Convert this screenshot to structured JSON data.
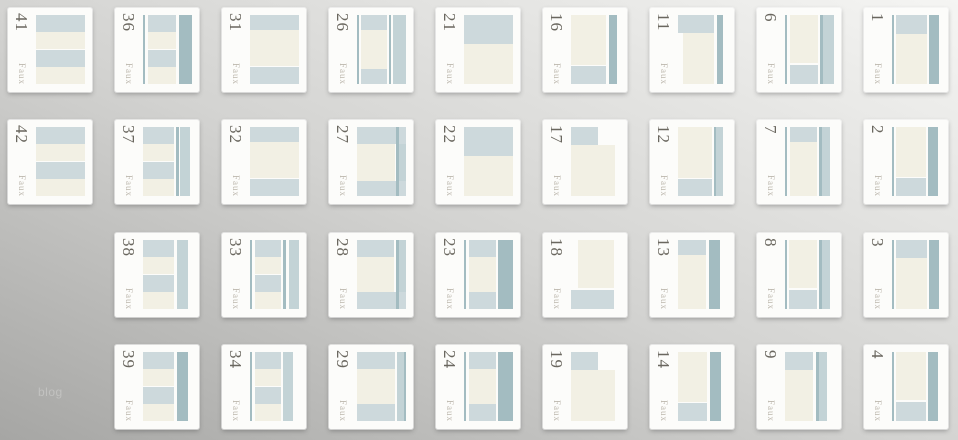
{
  "page": {
    "side_text": "blog",
    "watermark_label": "Faux"
  },
  "palette": {
    "light": "#cdd9dc",
    "mid": "#c3d3d6",
    "dark": "#a3bcc1",
    "cream": "#f2f0e4",
    "card_bg": "#fcfcfa",
    "number_color": "#6a675f",
    "label_color": "#bcb7ad",
    "blog_color": "#c2c2c0",
    "bg_top_right": "#f5f5f3",
    "bg_mid": "#d3d3d1",
    "bg_bottom_left": "#a6a6a4"
  },
  "grid": {
    "columns": 9,
    "rows": 4,
    "origin_x": 8,
    "col_pitch": 107,
    "row_tops": [
      8,
      120,
      233,
      345
    ],
    "card_size": 84
  },
  "cards": [
    {
      "number": "41",
      "col": 1,
      "row": 1,
      "blocks": [
        [
          0,
          0,
          100,
          24,
          "L"
        ],
        [
          0,
          24,
          100,
          26,
          "C"
        ],
        [
          0,
          50,
          100,
          26,
          "L"
        ],
        [
          0,
          76,
          100,
          24,
          "C"
        ]
      ]
    },
    {
      "number": "42",
      "col": 1,
      "row": 2,
      "blocks": [
        [
          0,
          0,
          100,
          24,
          "L"
        ],
        [
          0,
          24,
          100,
          26,
          "C"
        ],
        [
          0,
          50,
          100,
          26,
          "L"
        ],
        [
          0,
          76,
          100,
          24,
          "C"
        ]
      ]
    },
    {
      "number": "36",
      "col": 2,
      "row": 1,
      "blocks": [
        [
          0,
          0,
          5,
          100,
          "D"
        ],
        [
          10,
          0,
          58,
          24,
          "L"
        ],
        [
          10,
          24,
          58,
          26,
          "C"
        ],
        [
          10,
          50,
          58,
          26,
          "L"
        ],
        [
          10,
          76,
          58,
          24,
          "C"
        ],
        [
          73,
          0,
          27,
          100,
          "D"
        ]
      ]
    },
    {
      "number": "37",
      "col": 2,
      "row": 2,
      "blocks": [
        [
          0,
          0,
          64,
          24,
          "L"
        ],
        [
          0,
          24,
          64,
          26,
          "C"
        ],
        [
          0,
          50,
          64,
          26,
          "L"
        ],
        [
          0,
          76,
          64,
          24,
          "C"
        ],
        [
          68,
          0,
          5,
          100,
          "D"
        ],
        [
          75,
          0,
          21,
          100,
          "M"
        ]
      ]
    },
    {
      "number": "38",
      "col": 2,
      "row": 3,
      "blocks": [
        [
          0,
          0,
          64,
          24,
          "L"
        ],
        [
          0,
          24,
          64,
          26,
          "C"
        ],
        [
          0,
          50,
          64,
          26,
          "L"
        ],
        [
          0,
          76,
          64,
          24,
          "C"
        ],
        [
          70,
          0,
          22,
          100,
          "M"
        ]
      ]
    },
    {
      "number": "39",
      "col": 2,
      "row": 4,
      "blocks": [
        [
          0,
          0,
          64,
          24,
          "L"
        ],
        [
          0,
          24,
          64,
          26,
          "C"
        ],
        [
          0,
          50,
          64,
          26,
          "L"
        ],
        [
          0,
          76,
          64,
          24,
          "C"
        ],
        [
          70,
          0,
          22,
          100,
          "D"
        ]
      ]
    },
    {
      "number": "31",
      "col": 3,
      "row": 1,
      "blocks": [
        [
          0,
          0,
          100,
          22,
          "L"
        ],
        [
          0,
          22,
          100,
          52,
          "C"
        ],
        [
          0,
          76,
          100,
          24,
          "L"
        ]
      ]
    },
    {
      "number": "32",
      "col": 3,
      "row": 2,
      "blocks": [
        [
          0,
          0,
          100,
          22,
          "L"
        ],
        [
          0,
          22,
          100,
          52,
          "C"
        ],
        [
          0,
          76,
          100,
          24,
          "L"
        ]
      ]
    },
    {
      "number": "33",
      "col": 3,
      "row": 3,
      "blocks": [
        [
          0,
          0,
          5,
          100,
          "D"
        ],
        [
          10,
          0,
          54,
          24,
          "L"
        ],
        [
          10,
          24,
          54,
          26,
          "C"
        ],
        [
          10,
          50,
          54,
          26,
          "L"
        ],
        [
          10,
          76,
          54,
          24,
          "C"
        ],
        [
          68,
          0,
          5,
          100,
          "D"
        ],
        [
          79,
          0,
          21,
          100,
          "M"
        ]
      ]
    },
    {
      "number": "34",
      "col": 3,
      "row": 4,
      "blocks": [
        [
          0,
          0,
          5,
          100,
          "D"
        ],
        [
          10,
          0,
          54,
          24,
          "L"
        ],
        [
          10,
          24,
          54,
          26,
          "C"
        ],
        [
          10,
          50,
          54,
          26,
          "L"
        ],
        [
          10,
          76,
          54,
          24,
          "C"
        ],
        [
          68,
          0,
          20,
          100,
          "M"
        ]
      ]
    },
    {
      "number": "26",
      "col": 4,
      "row": 1,
      "blocks": [
        [
          0,
          0,
          4,
          100,
          "D"
        ],
        [
          8,
          0,
          54,
          22,
          "L"
        ],
        [
          8,
          22,
          54,
          56,
          "C"
        ],
        [
          8,
          78,
          54,
          22,
          "L"
        ],
        [
          66,
          0,
          4,
          100,
          "D"
        ],
        [
          74,
          0,
          26,
          100,
          "M"
        ]
      ]
    },
    {
      "number": "27",
      "col": 4,
      "row": 2,
      "blocks": [
        [
          0,
          0,
          100,
          24,
          "L"
        ],
        [
          0,
          24,
          78,
          54,
          "C"
        ],
        [
          0,
          78,
          100,
          22,
          "L"
        ],
        [
          80,
          0,
          5,
          100,
          "D"
        ],
        [
          85,
          24,
          15,
          54,
          "M"
        ]
      ]
    },
    {
      "number": "28",
      "col": 4,
      "row": 3,
      "blocks": [
        [
          0,
          0,
          76,
          24,
          "L"
        ],
        [
          0,
          24,
          76,
          52,
          "C"
        ],
        [
          0,
          76,
          100,
          24,
          "L"
        ],
        [
          80,
          0,
          5,
          100,
          "D"
        ],
        [
          85,
          0,
          15,
          76,
          "M"
        ]
      ]
    },
    {
      "number": "29",
      "col": 4,
      "row": 4,
      "blocks": [
        [
          0,
          0,
          78,
          24,
          "L"
        ],
        [
          0,
          24,
          78,
          52,
          "C"
        ],
        [
          0,
          76,
          78,
          24,
          "L"
        ],
        [
          82,
          0,
          14,
          100,
          "M"
        ],
        [
          96,
          0,
          4,
          100,
          "D"
        ]
      ]
    },
    {
      "number": "21",
      "col": 5,
      "row": 1,
      "blocks": [
        [
          0,
          0,
          100,
          42,
          "L"
        ],
        [
          0,
          42,
          100,
          58,
          "C"
        ]
      ]
    },
    {
      "number": "22",
      "col": 5,
      "row": 2,
      "blocks": [
        [
          0,
          0,
          100,
          42,
          "L"
        ],
        [
          0,
          42,
          100,
          58,
          "C"
        ]
      ]
    },
    {
      "number": "23",
      "col": 5,
      "row": 3,
      "blocks": [
        [
          0,
          0,
          5,
          100,
          "D"
        ],
        [
          10,
          0,
          56,
          24,
          "L"
        ],
        [
          10,
          24,
          56,
          52,
          "C"
        ],
        [
          10,
          76,
          56,
          24,
          "L"
        ],
        [
          70,
          0,
          30,
          100,
          "D"
        ]
      ]
    },
    {
      "number": "24",
      "col": 5,
      "row": 4,
      "blocks": [
        [
          0,
          0,
          5,
          100,
          "D"
        ],
        [
          10,
          0,
          56,
          24,
          "L"
        ],
        [
          10,
          24,
          56,
          52,
          "C"
        ],
        [
          10,
          76,
          56,
          24,
          "L"
        ],
        [
          70,
          0,
          30,
          100,
          "D"
        ]
      ]
    },
    {
      "number": "16",
      "col": 6,
      "row": 1,
      "blocks": [
        [
          0,
          0,
          72,
          72,
          "C"
        ],
        [
          0,
          74,
          72,
          26,
          "L"
        ],
        [
          78,
          0,
          15,
          100,
          "D"
        ]
      ]
    },
    {
      "number": "17",
      "col": 6,
      "row": 2,
      "blocks": [
        [
          0,
          0,
          56,
          26,
          "L"
        ],
        [
          0,
          26,
          90,
          74,
          "C"
        ]
      ]
    },
    {
      "number": "18",
      "col": 6,
      "row": 3,
      "blocks": [
        [
          14,
          0,
          74,
          70,
          "C"
        ],
        [
          0,
          72,
          88,
          28,
          "L"
        ]
      ]
    },
    {
      "number": "19",
      "col": 6,
      "row": 4,
      "blocks": [
        [
          0,
          0,
          56,
          26,
          "L"
        ],
        [
          0,
          26,
          90,
          74,
          "C"
        ]
      ]
    },
    {
      "number": "11",
      "col": 7,
      "row": 1,
      "blocks": [
        [
          0,
          0,
          74,
          26,
          "L"
        ],
        [
          10,
          26,
          64,
          74,
          "C"
        ],
        [
          79,
          0,
          13,
          100,
          "D"
        ]
      ]
    },
    {
      "number": "12",
      "col": 7,
      "row": 2,
      "blocks": [
        [
          0,
          0,
          70,
          74,
          "C"
        ],
        [
          0,
          76,
          70,
          24,
          "L"
        ],
        [
          73,
          0,
          5,
          100,
          "D"
        ],
        [
          78,
          0,
          14,
          100,
          "M"
        ]
      ]
    },
    {
      "number": "13",
      "col": 7,
      "row": 3,
      "blocks": [
        [
          0,
          0,
          58,
          22,
          "L"
        ],
        [
          0,
          22,
          58,
          78,
          "C"
        ],
        [
          63,
          0,
          22,
          100,
          "D"
        ]
      ]
    },
    {
      "number": "14",
      "col": 7,
      "row": 4,
      "blocks": [
        [
          0,
          0,
          60,
          72,
          "C"
        ],
        [
          0,
          74,
          60,
          26,
          "L"
        ],
        [
          65,
          0,
          22,
          100,
          "D"
        ]
      ]
    },
    {
      "number": "6",
      "col": 8,
      "row": 1,
      "blocks": [
        [
          0,
          0,
          5,
          100,
          "D"
        ],
        [
          10,
          0,
          58,
          70,
          "C"
        ],
        [
          10,
          72,
          58,
          28,
          "L"
        ],
        [
          72,
          0,
          5,
          100,
          "D"
        ],
        [
          77,
          0,
          23,
          100,
          "M"
        ]
      ]
    },
    {
      "number": "7",
      "col": 8,
      "row": 2,
      "blocks": [
        [
          0,
          0,
          5,
          100,
          "D"
        ],
        [
          10,
          0,
          56,
          22,
          "L"
        ],
        [
          10,
          22,
          56,
          78,
          "C"
        ],
        [
          70,
          0,
          5,
          100,
          "D"
        ],
        [
          75,
          0,
          17,
          100,
          "M"
        ]
      ]
    },
    {
      "number": "8",
      "col": 8,
      "row": 3,
      "blocks": [
        [
          0,
          0,
          5,
          100,
          "D"
        ],
        [
          9,
          0,
          57,
          70,
          "C"
        ],
        [
          9,
          72,
          57,
          28,
          "L"
        ],
        [
          70,
          0,
          5,
          100,
          "D"
        ],
        [
          75,
          0,
          17,
          100,
          "M"
        ]
      ]
    },
    {
      "number": "9",
      "col": 8,
      "row": 4,
      "blocks": [
        [
          0,
          0,
          58,
          26,
          "L"
        ],
        [
          0,
          26,
          58,
          74,
          "C"
        ],
        [
          64,
          0,
          5,
          100,
          "D"
        ],
        [
          69,
          0,
          17,
          100,
          "M"
        ]
      ]
    },
    {
      "number": "1",
      "col": 9,
      "row": 1,
      "blocks": [
        [
          0,
          0,
          5,
          100,
          "D"
        ],
        [
          9,
          0,
          62,
          28,
          "L"
        ],
        [
          9,
          28,
          62,
          72,
          "C"
        ],
        [
          75,
          0,
          21,
          100,
          "D"
        ]
      ]
    },
    {
      "number": "2",
      "col": 9,
      "row": 2,
      "blocks": [
        [
          0,
          0,
          5,
          100,
          "D"
        ],
        [
          9,
          0,
          60,
          72,
          "C"
        ],
        [
          9,
          74,
          60,
          26,
          "L"
        ],
        [
          73,
          0,
          21,
          100,
          "D"
        ]
      ]
    },
    {
      "number": "3",
      "col": 9,
      "row": 3,
      "blocks": [
        [
          0,
          0,
          5,
          100,
          "D"
        ],
        [
          9,
          0,
          62,
          26,
          "L"
        ],
        [
          9,
          26,
          62,
          74,
          "C"
        ],
        [
          75,
          0,
          21,
          100,
          "D"
        ]
      ]
    },
    {
      "number": "4",
      "col": 9,
      "row": 4,
      "blocks": [
        [
          0,
          0,
          5,
          100,
          "D"
        ],
        [
          9,
          0,
          60,
          70,
          "C"
        ],
        [
          9,
          72,
          60,
          28,
          "L"
        ],
        [
          73,
          0,
          21,
          100,
          "D"
        ]
      ]
    }
  ]
}
